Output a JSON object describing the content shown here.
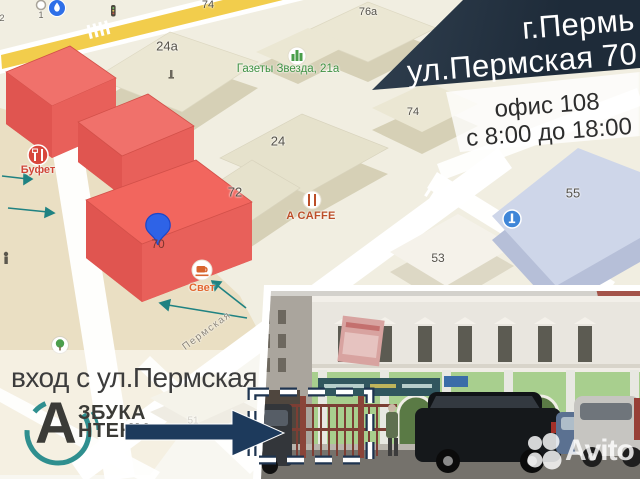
{
  "header": {
    "city": "г.Пермь",
    "address": "ул.Пермская 70",
    "office": "офис 108",
    "hours": "с 8:00 до 18:00"
  },
  "map": {
    "labels": {
      "h74_top": "74",
      "h76a": "76а",
      "h24a": "24а",
      "h74": "74",
      "h24": "24",
      "h72": "72",
      "h70": "70",
      "h53": "53",
      "h55": "55",
      "h51": "51",
      "street": "Пермская",
      "marker1": "1",
      "marker2": "2"
    },
    "pois": {
      "gazeta": "Газеты Звезда, 21а",
      "bufet": "Буфет",
      "acaffe": "A CAFFE",
      "svet": "Свет"
    }
  },
  "footer": {
    "entrance": "вход с ул.Пермская",
    "logo": {
      "letter": "А",
      "top": "ЗБУКА",
      "bottom": "НТЕНН"
    }
  },
  "watermark": "Avito",
  "colors": {
    "highlight_building": "#f0655e",
    "banner_navy": "#1e2b39",
    "arrow_navy": "#1d3a5c",
    "logo_teal": "#2f8f8f",
    "pin_blue": "#2e63e7",
    "map_bg": "#f1eee1",
    "facade_green": "#a8cf8e"
  }
}
